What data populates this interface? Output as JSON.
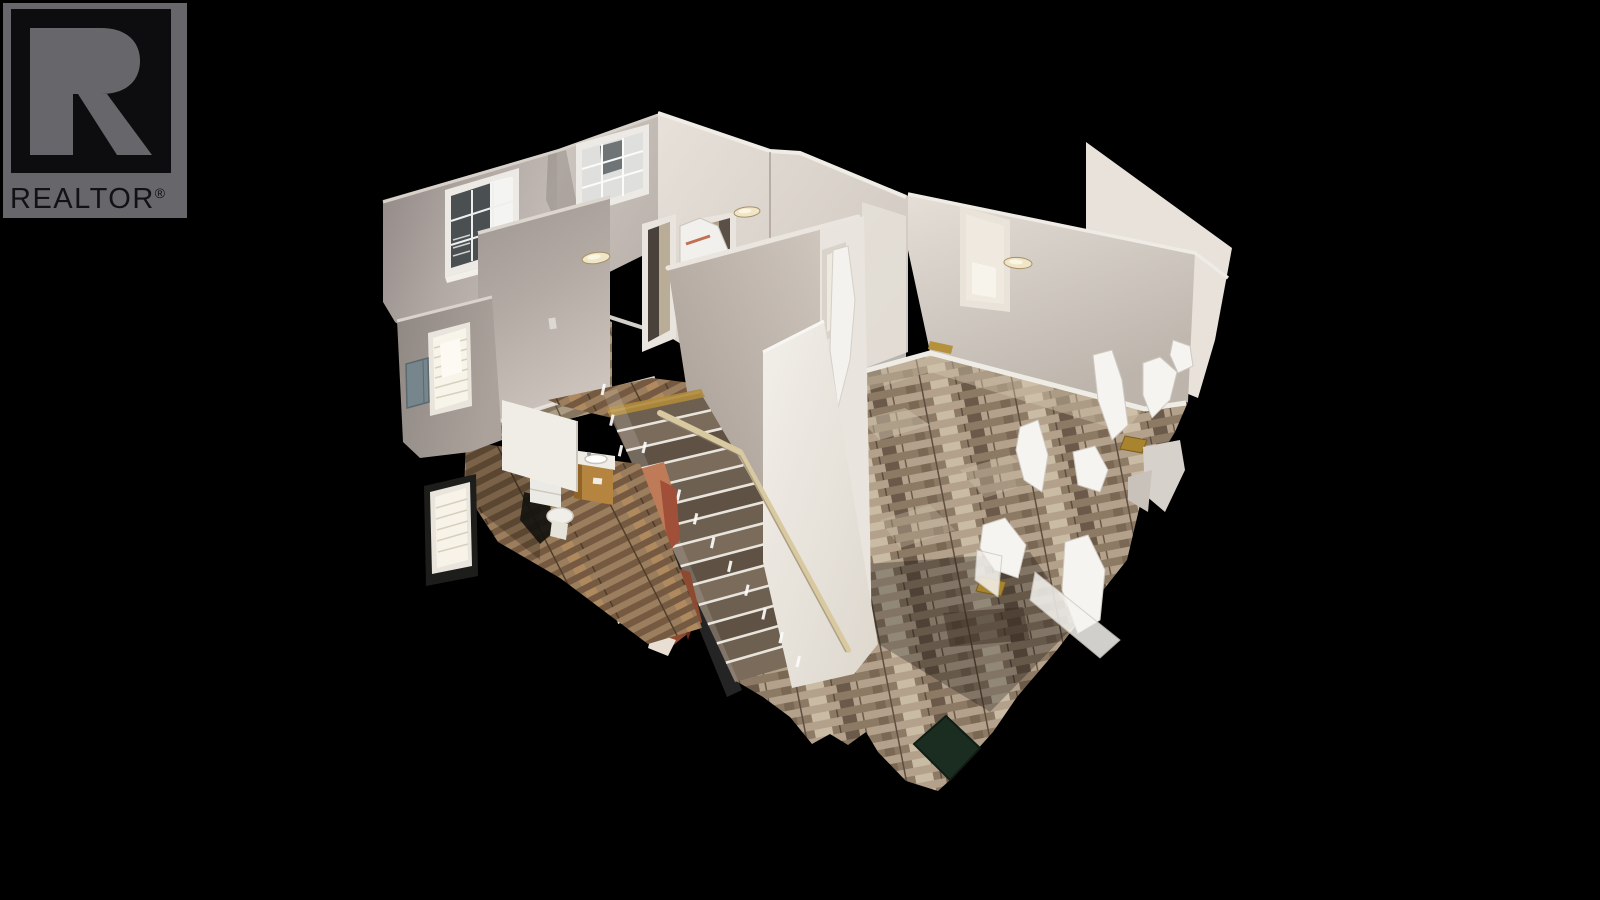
{
  "watermark": {
    "brand": "REALTOR",
    "registered_mark": "®",
    "logo_letter": "R"
  },
  "scene": {
    "label": "3D dollhouse tour view",
    "subject": "Cutaway overhead 3D scan of an empty home upper floor with staircase, hallway, bedroom, bathroom and wood-floored living area",
    "style": "photogrammetry scan with floating white scan artifacts",
    "background": "#000000"
  },
  "palette": {
    "logo_gray": "#67676b",
    "logo_black": "#0d0d10",
    "wall_light": "#e8e3dc",
    "wall_mid": "#b6ada6",
    "wall_shadow": "#968e88",
    "floor_wood_gray": "#a4917b",
    "floor_wood_warm": "#8a6f52",
    "stair_tread": "#6e6051",
    "handrail_beige": "#d9c9a0",
    "vanity_wood": "#b5853f",
    "fixture_white": "#f0eeea",
    "artifact_copper": "#bf7a58",
    "mat_green": "#1b2d21",
    "threshold_brass": "#a8842f",
    "window_glow": "#f7f4ea"
  }
}
